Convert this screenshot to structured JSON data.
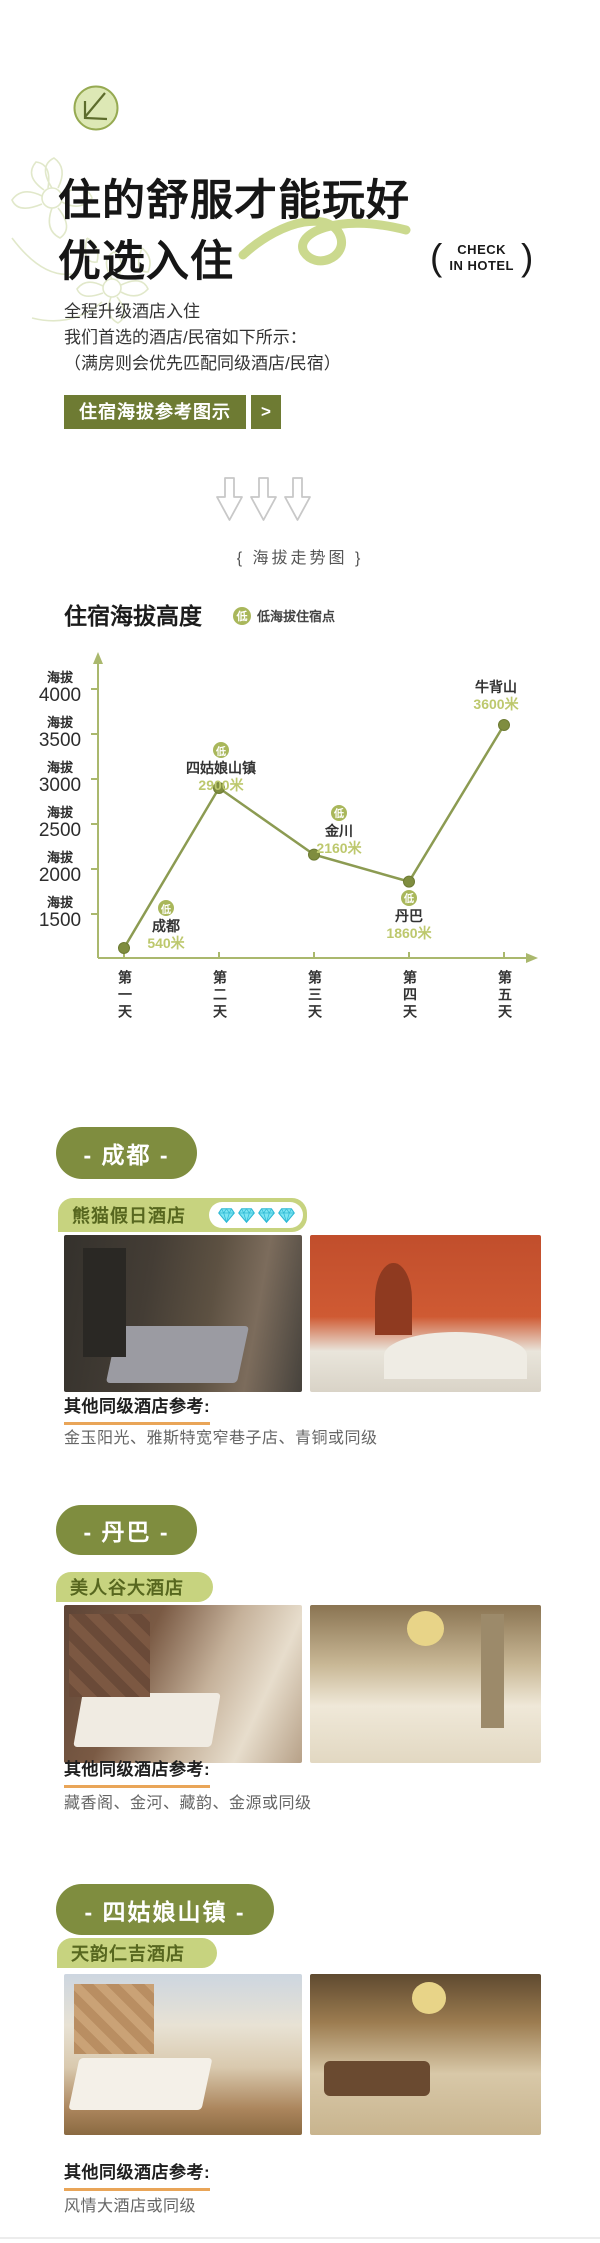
{
  "header": {
    "title_line1": "住的舒服才能玩好",
    "title_line2": "优选入住",
    "check_in": {
      "left_paren": "(",
      "line1": "CHECK",
      "line2": "IN HOTEL",
      "right_paren": ")"
    },
    "intro_lines": [
      "全程升级酒店入住",
      "我们首选的酒店/民宿如下所示：",
      "（满房则会优先匹配同级酒店/民宿）"
    ],
    "cta_button": {
      "label": "住宿海拔参考图示",
      "arrow": ">"
    },
    "section_caption": "{ 海拔走势图 }"
  },
  "chart": {
    "title": "住宿海拔高度",
    "legend": {
      "badge": "低",
      "label": "低海拔住宿点"
    }
  },
  "chart_data": {
    "type": "line",
    "title": "住宿海拔高度",
    "x_labels": [
      "第一天",
      "第二天",
      "第三天",
      "第四天",
      "第五天"
    ],
    "y_tick_prefix": "海拔",
    "y_ticks": [
      4000,
      3500,
      3000,
      2500,
      2000,
      1500
    ],
    "ylim": [
      1000,
      4300
    ],
    "grid": false,
    "legend_position": "top",
    "series": [
      {
        "name": "住宿海拔高度",
        "values": [
          540,
          2900,
          2160,
          1860,
          3600
        ]
      }
    ],
    "points": [
      {
        "day": "第一天",
        "place": "成都",
        "altitude_m": 540,
        "value_label": "540米",
        "low_badge": true
      },
      {
        "day": "第二天",
        "place": "四姑娘山镇",
        "altitude_m": 2900,
        "value_label": "2900米",
        "low_badge": true
      },
      {
        "day": "第三天",
        "place": "金川",
        "altitude_m": 2160,
        "value_label": "2160米",
        "low_badge": true
      },
      {
        "day": "第四天",
        "place": "丹巴",
        "altitude_m": 1860,
        "value_label": "1860米",
        "low_badge": true
      },
      {
        "day": "第五天",
        "place": "牛背山",
        "altitude_m": 3600,
        "value_label": "3600米",
        "low_badge": false
      }
    ]
  },
  "sections": [
    {
      "city_pill": "- 成都 -",
      "hotel_name": "熊猫假日酒店",
      "diamond_count": 4,
      "ref_title": "其他同级酒店参考:",
      "ref_hotels": "金玉阳光、雅斯特宽窄巷子店、青铜或同级"
    },
    {
      "city_pill": "- 丹巴 -",
      "hotel_name": "美人谷大酒店",
      "diamond_count": 0,
      "ref_title": "其他同级酒店参考:",
      "ref_hotels": "藏香阁、金河、藏韵、金源或同级"
    },
    {
      "city_pill": "- 四姑娘山镇 -",
      "hotel_name": "天韵仁吉酒店",
      "diamond_count": 0,
      "ref_title": "其他同级酒店参考:",
      "ref_hotels": "风情大酒店或同级"
    }
  ],
  "colors": {
    "accent_olive": "#6e7b33",
    "pill_green": "#7f8d3f",
    "tab_light_green": "#c7d37f",
    "tab_text_green": "#57671f",
    "chart_line_olive": "#8c9b52",
    "value_text_olive": "#bdc86d",
    "badge_olive": "#a9b75b",
    "underline_orange": "#e9a558",
    "diamond_cyan": "#7ce4f2"
  }
}
